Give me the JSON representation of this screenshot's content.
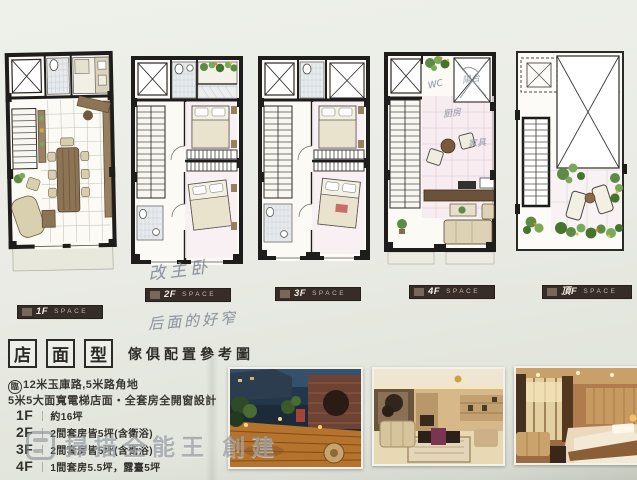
{
  "floor_labels": [
    {
      "floor": "1F",
      "space": "SPACE"
    },
    {
      "floor": "2F",
      "space": "SPACE"
    },
    {
      "floor": "3F",
      "space": "SPACE"
    },
    {
      "floor": "4F",
      "space": "SPACE"
    },
    {
      "floor": "頂F",
      "space": "SPACE"
    }
  ],
  "title": {
    "boxed": [
      "店",
      "面",
      "型"
    ],
    "subtitle": "傢俱配置參考圖"
  },
  "specs": {
    "line1_prefix": "臨",
    "line1": "12米玉庫路,5米路角地",
    "line2": "5米5大面寬電梯店面・全套房全開窗設計",
    "floors": [
      {
        "floor": "1F",
        "sep": "｜",
        "desc": "約16坪"
      },
      {
        "floor": "2F",
        "sep": "｜",
        "desc": "2間套房皆5坪(含衛浴)"
      },
      {
        "floor": "3F",
        "sep": "｜",
        "desc": "2間套房皆5坪(含衛浴)"
      },
      {
        "floor": "4F",
        "sep": "｜",
        "desc": "1間套房5.5坪，露臺5坪"
      }
    ]
  },
  "handwriting": {
    "note1": "改主卧",
    "note2": "后面的好窄",
    "wc": "WC",
    "balcony": "陽台",
    "kitchen": "厨房",
    "furniture": "家具"
  },
  "watermark": {
    "text": "掃描全能王 創建"
  },
  "photos": [
    {
      "name": "roof-deck-night-photo"
    },
    {
      "name": "living-room-photo"
    },
    {
      "name": "bedroom-photo"
    }
  ],
  "colors": {
    "paper": "#e9ebe4",
    "wall": "#1f1d1b",
    "label_bar": "#362d28",
    "furniture_brown": "#8d7454",
    "furniture_beige": "#d9d0b0",
    "greenery": "#5d8b43",
    "pink_floor": "#f7edf2",
    "watermark_gray": "#7a8188"
  }
}
